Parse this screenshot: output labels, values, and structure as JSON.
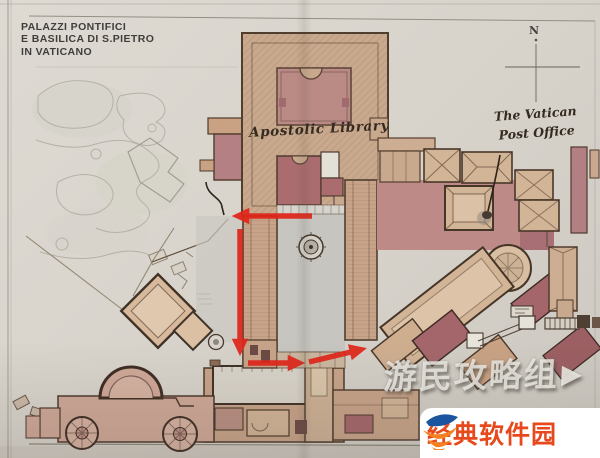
{
  "title": {
    "lines": [
      "PALAZZI PONTIFICI",
      "E BASILICA DI S.PIETRO",
      "IN VATICANO"
    ]
  },
  "map": {
    "labels": {
      "library": "Apostolic Library",
      "post_office_line1": "The Vatican",
      "post_office_line2": "Post Office"
    },
    "compass": {
      "north": "N"
    },
    "colors": {
      "paper": "#d8d4cc",
      "building_tan": "#c9a98d",
      "roof_maroon": "#a4666b",
      "courtyard_pink": "#ba8a85",
      "plaza_pink": "#bd8a88",
      "courtyard_gray": "#c6c5bf",
      "outline_ink": "#4a382a",
      "route_red": "#e0261a"
    },
    "icons": {
      "compass": "compass-cross",
      "fountain": "fountain-circle",
      "post_office_marker": "ink-dot"
    }
  },
  "watermarks": {
    "guide_group": {
      "text": "游民攻略组",
      "arrow_icon": "▶"
    },
    "site_badge": {
      "text": "经典软件园",
      "text_color": "#e8491c",
      "logo_blue": "#1b55a0",
      "logo_orange": "#f48120"
    }
  }
}
